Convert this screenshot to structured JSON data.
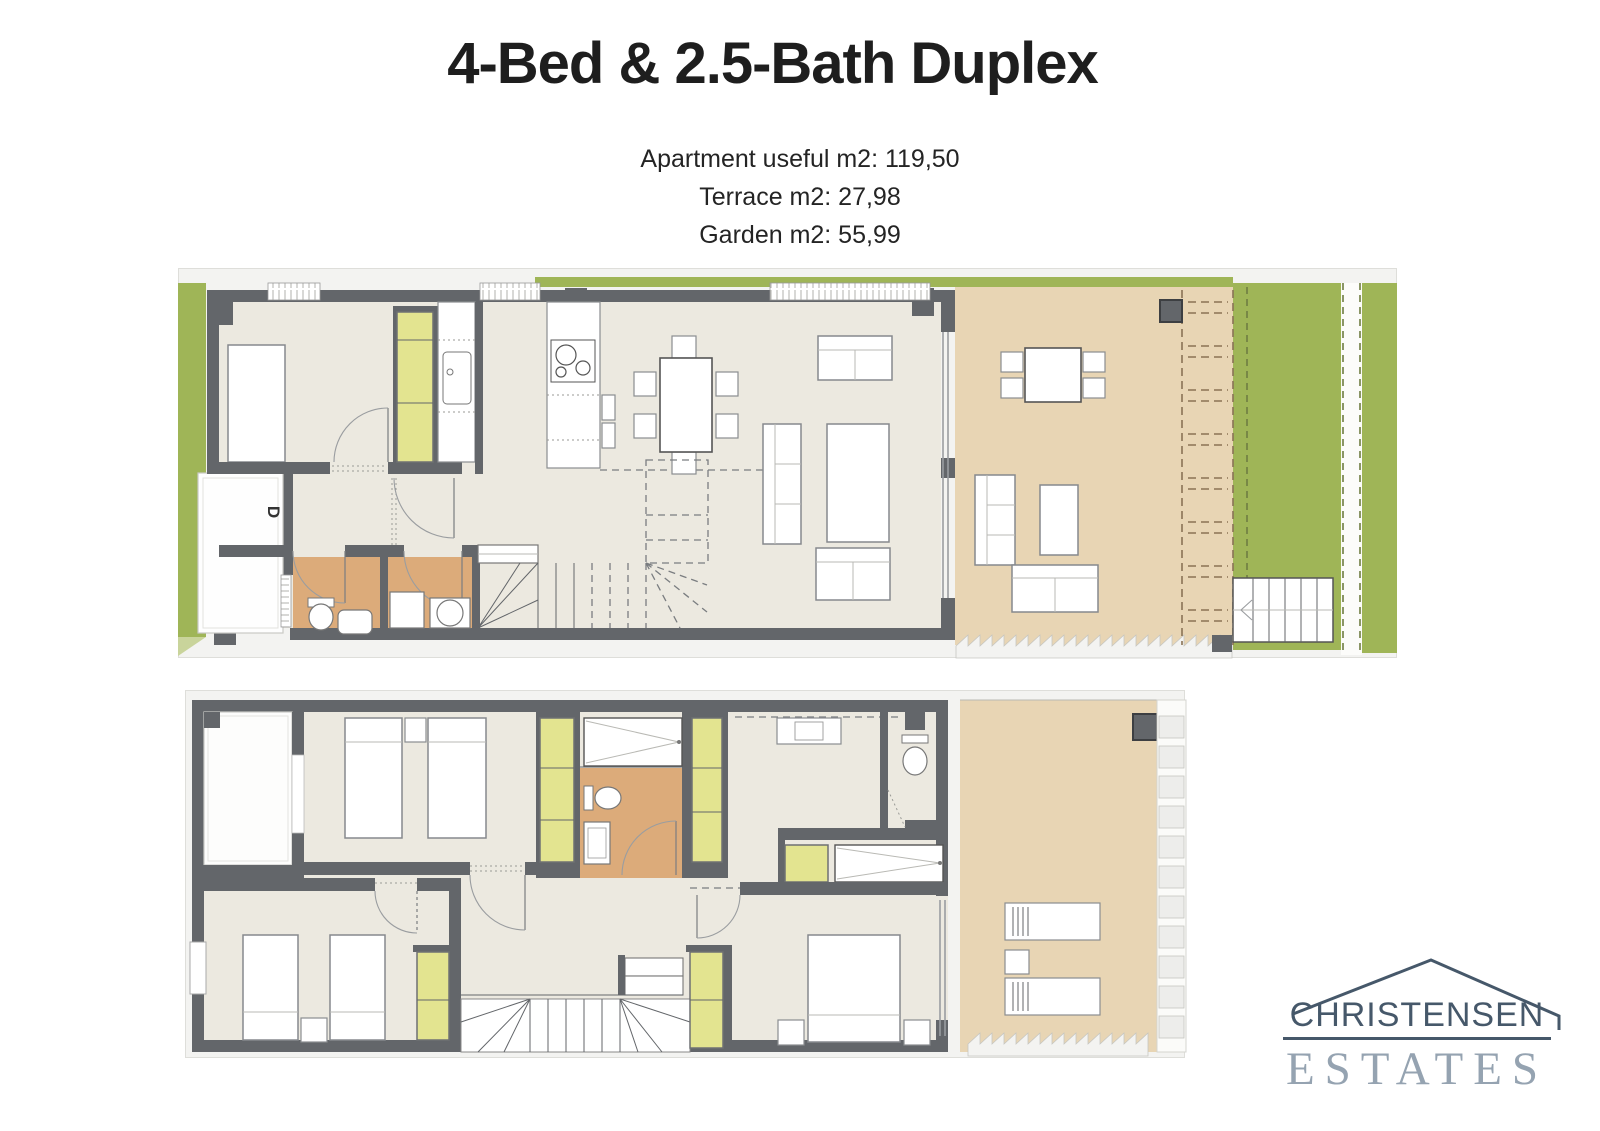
{
  "header": {
    "title": "4-Bed & 2.5-Bath Duplex",
    "stats": {
      "apartment": "Apartment useful m2: 119,50",
      "terrace": "Terrace m2: 27,98",
      "garden": "Garden m2: 55,99"
    }
  },
  "plans": {
    "ground_floor": {
      "entrance_label": "D"
    },
    "upper_floor": {}
  },
  "logo": {
    "name": "CHRISTENSEN",
    "tagline": "ESTATES"
  },
  "colors": {
    "wall": "#63666a",
    "interior_floor": "#ece9e0",
    "terrace": "#e8d5b4",
    "garden_green": "#9fb557",
    "bathroom_floor": "#dcab7a",
    "closet_yellow": "#e3e490",
    "logo_primary": "#46586a",
    "logo_secondary": "#95a3b1"
  }
}
